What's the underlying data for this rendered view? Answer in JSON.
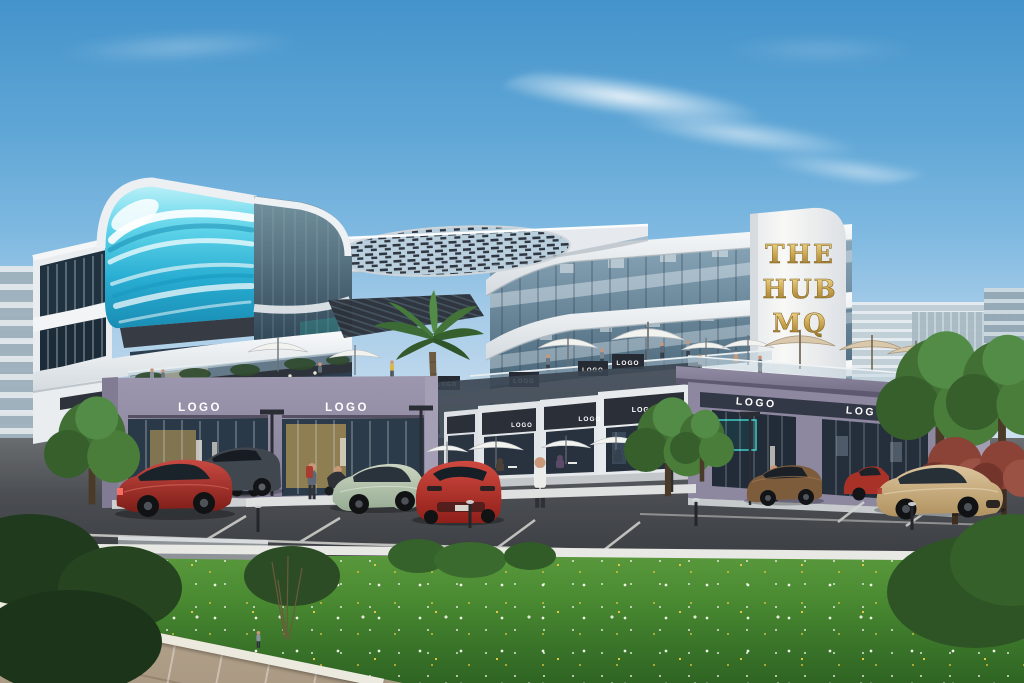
{
  "scene": {
    "type": "architectural-rendering-exterior",
    "building_name": "THE HUB MQ",
    "tower_sign": {
      "line1": "THE",
      "line2": "HUB",
      "line3": "MQ"
    },
    "logo_label": "LOGO",
    "counts": {
      "visible_logo_signs": 12
    },
    "colors": {
      "sky_top": "#4493cb",
      "sky_horizon": "#c9def0",
      "led_screen_cyan": "#35c4e0",
      "facade_white": "#eef1f4",
      "storefront_purple": "#8f89a2",
      "fascia_dark": "#343945",
      "sign_gold": "#c9a44d",
      "glass_dark": "#2e4152",
      "asphalt_gray": "#46494d",
      "grass_green": "#4f8f33",
      "flower_white": "#f2f2ea",
      "flower_yellow": "#e9cd42",
      "car_red_sedan": "#b5342f",
      "car_suv_gray": "#3c4248",
      "car_purple": "#9b8fc4",
      "car_green_coupe": "#b7c7ae",
      "car_red_sports": "#c33d34",
      "car_brown": "#7d5c3c",
      "car_red_small": "#a83228",
      "car_beige": "#d0b78f"
    }
  }
}
